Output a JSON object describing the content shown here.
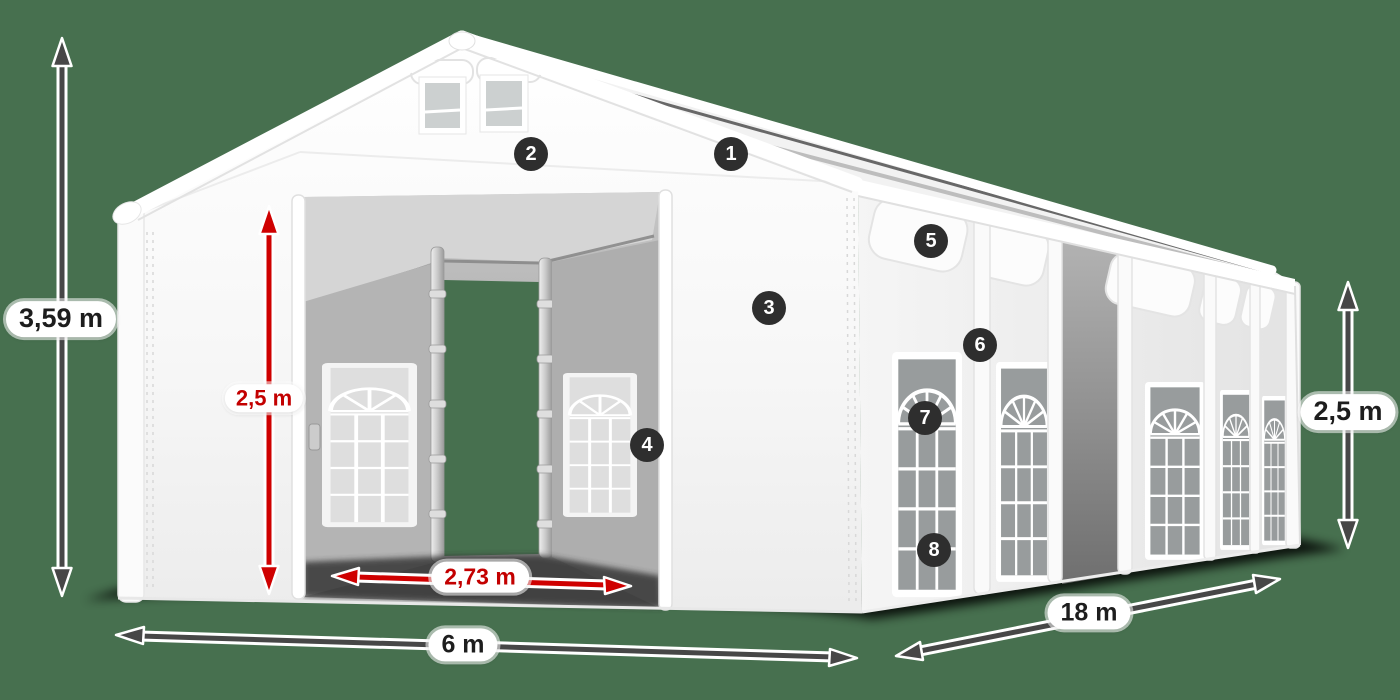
{
  "background_color": "#47704f",
  "scene": {
    "subject": "White PVC storage/party tent with open gable entrance, arched side windows, numbered feature callouts and dimension arrows",
    "tent_base_color": "#f7f7f7",
    "ground_shadow_color": "#000000"
  },
  "measurements": {
    "total_height": {
      "label": "3,59 m",
      "style": "gray"
    },
    "door_height": {
      "label": "2,5 m",
      "style": "red"
    },
    "door_width": {
      "label": "2,73 m",
      "style": "red"
    },
    "front_width": {
      "label": "6 m",
      "style": "gray"
    },
    "side_length": {
      "label": "18 m",
      "style": "gray"
    },
    "side_height": {
      "label": "2,5 m",
      "style": "gray"
    }
  },
  "colors": {
    "arrow_gray": "#474747",
    "arrow_red": "#cf0000",
    "label_text_dark": "#1d1d1d",
    "label_text_red": "#c30000",
    "label_pill_bg": "#ffffff",
    "callout_bg": "#2e2e2e",
    "callout_text": "#ffffff"
  },
  "callouts": [
    {
      "number": "1"
    },
    {
      "number": "2"
    },
    {
      "number": "3"
    },
    {
      "number": "4"
    },
    {
      "number": "5"
    },
    {
      "number": "6"
    },
    {
      "number": "7"
    },
    {
      "number": "8"
    }
  ]
}
